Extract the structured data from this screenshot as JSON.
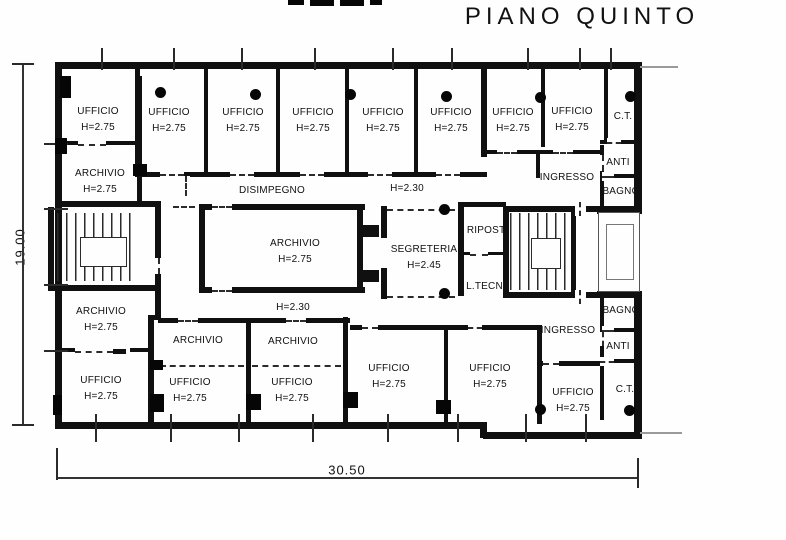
{
  "title": "PIANO QUINTO",
  "dimensions": {
    "height": "19.00",
    "width": "30.50"
  },
  "colors": {
    "wall_ink": "#101010",
    "paper": "#fefefe"
  },
  "rooms": [
    {
      "label": "UFFICIO",
      "height": "H=2.75"
    },
    {
      "label": "UFFICIO",
      "height": "H=2.75"
    },
    {
      "label": "UFFICIO",
      "height": "H=2.75"
    },
    {
      "label": "UFFICIO",
      "height": "H=2.75"
    },
    {
      "label": "UFFICIO",
      "height": "H=2.75"
    },
    {
      "label": "UFFICIO",
      "height": "H=2.75"
    },
    {
      "label": "UFFICIO",
      "height": "H=2.75"
    },
    {
      "label": "UFFICIO",
      "height": "H=2.75"
    },
    {
      "label": "C.T.",
      "height": ""
    },
    {
      "label": "ARCHIVIO",
      "height": "H=2.75"
    },
    {
      "label": "DISIMPEGNO",
      "height": ""
    },
    {
      "label": "H=2.30",
      "height": ""
    },
    {
      "label": "INGRESSO",
      "height": ""
    },
    {
      "label": "ANTI",
      "height": ""
    },
    {
      "label": "BAGNO",
      "height": ""
    },
    {
      "label": "ARCHIVIO",
      "height": "H=2.75"
    },
    {
      "label": "SEGRETERIA",
      "height": "H=2.45"
    },
    {
      "label": "RIPOST.",
      "height": ""
    },
    {
      "label": "L.TECN.",
      "height": ""
    },
    {
      "label": "ARCHIVIO",
      "height": "H=2.75"
    },
    {
      "label": "H=2.30",
      "height": ""
    },
    {
      "label": "BAGNO",
      "height": ""
    },
    {
      "label": "INGRESSO",
      "height": ""
    },
    {
      "label": "ANTI",
      "height": ""
    },
    {
      "label": "ARCHIVIO",
      "height": ""
    },
    {
      "label": "ARCHIVIO",
      "height": ""
    },
    {
      "label": "UFFICIO",
      "height": "H=2.75"
    },
    {
      "label": "UFFICIO",
      "height": "H=2.75"
    },
    {
      "label": "UFFICIO",
      "height": "H=2.75"
    },
    {
      "label": "UFFICIO",
      "height": "H=2.75"
    },
    {
      "label": "UFFICIO",
      "height": "H=2.75"
    },
    {
      "label": "UFFICIO",
      "height": "H=2.75"
    },
    {
      "label": "C.T.",
      "height": ""
    }
  ]
}
